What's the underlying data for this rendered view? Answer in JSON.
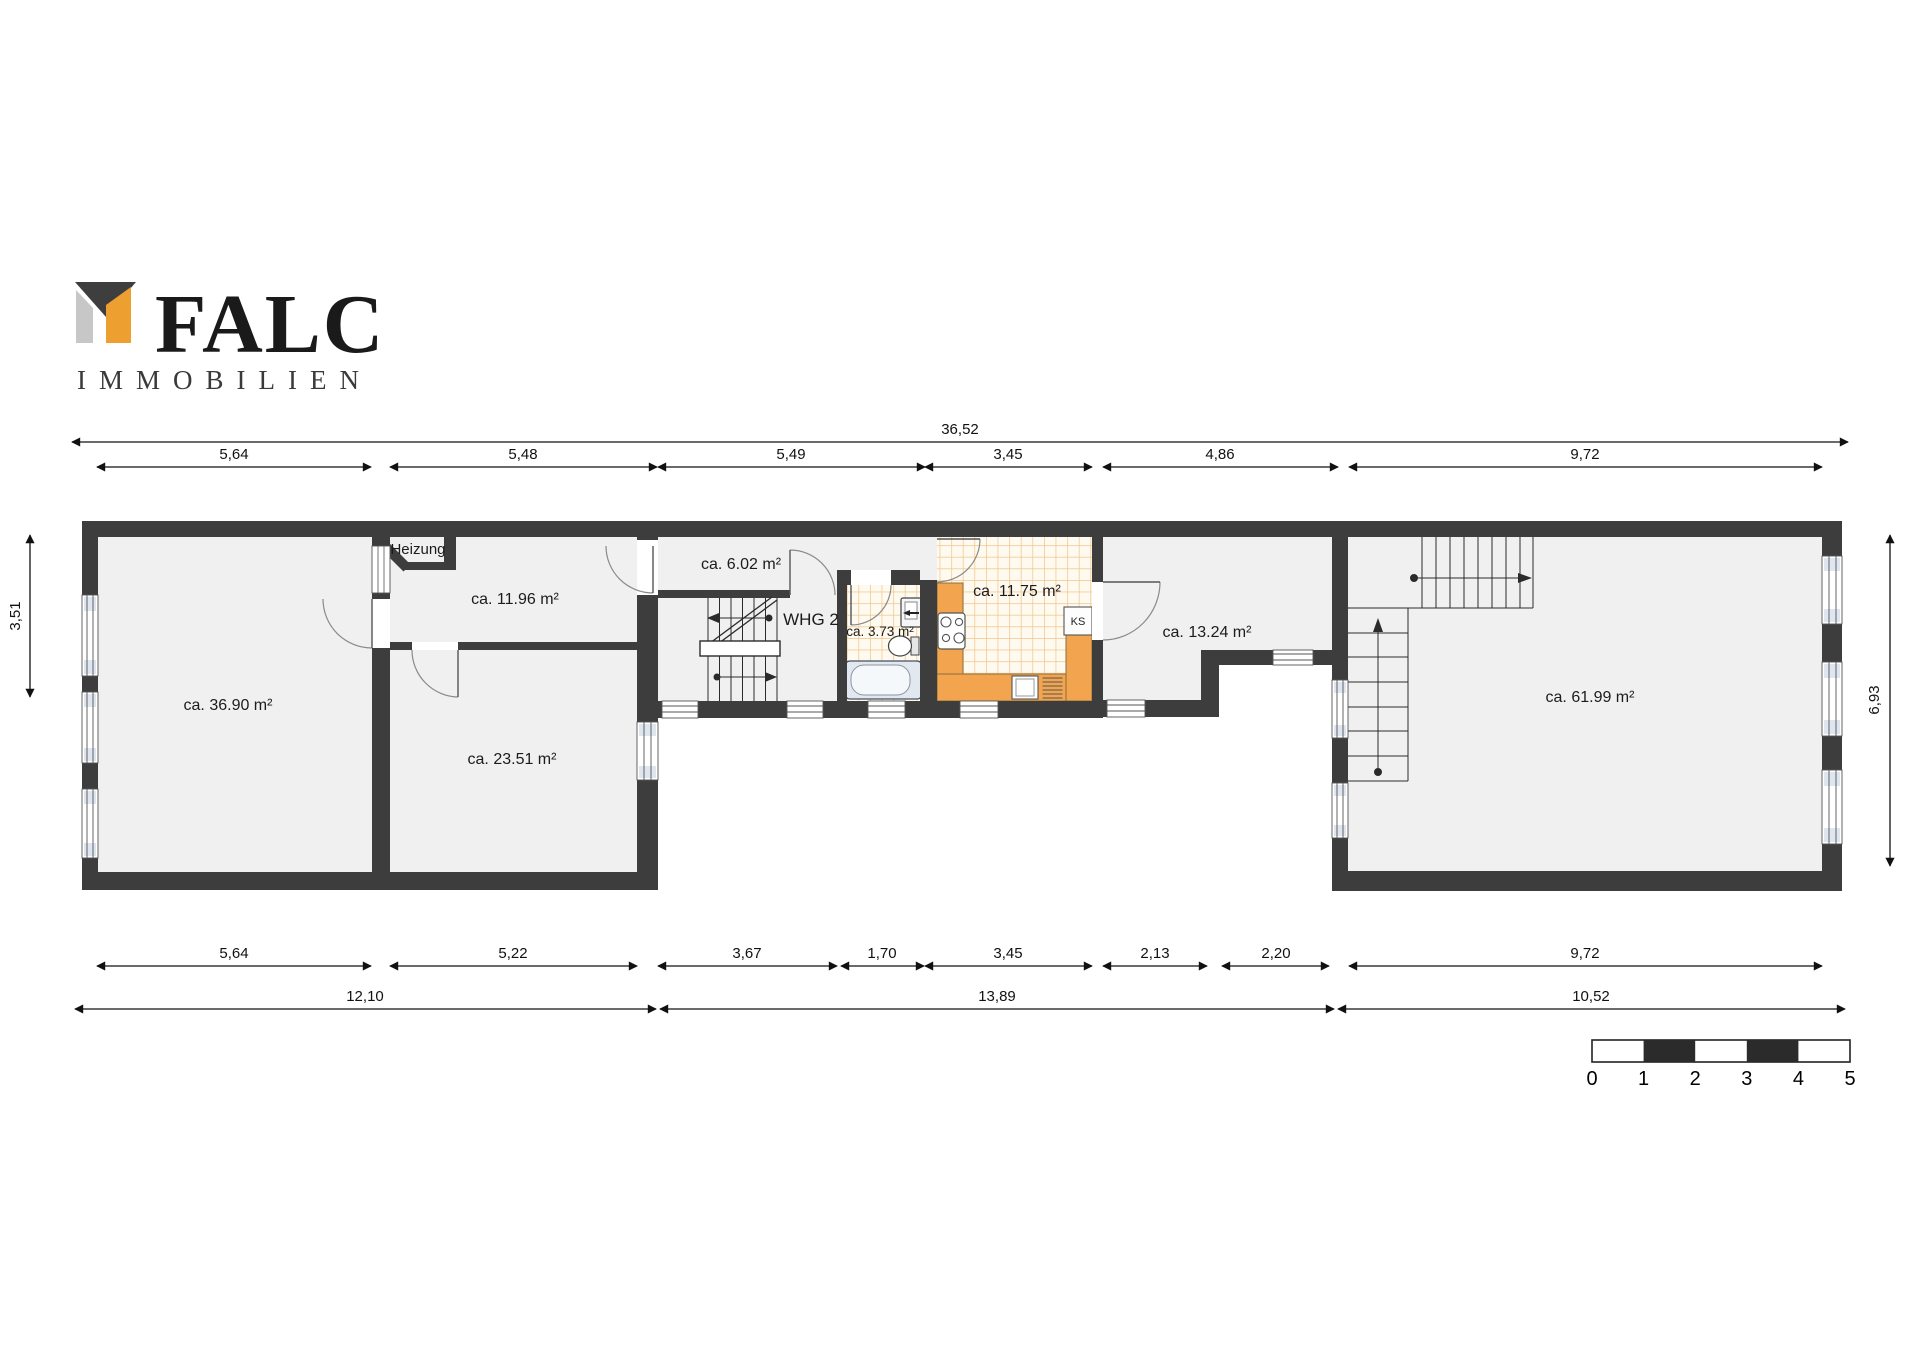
{
  "logo": {
    "brand": "FALC",
    "subtitle": "IMMOBILIEN",
    "brand_color": "#EDA02F",
    "mark_dark": "#3F3E3E",
    "mark_gray": "#C8C7C7"
  },
  "rooms": {
    "living": "ca. 36.90 m²",
    "room_1196": "ca. 11.96 m²",
    "room_2351": "ca. 23.51 m²",
    "hall": "ca. 6.02 m²",
    "whg": "WHG 2",
    "bath": "ca. 3.73 m²",
    "kitchen": "ca. 11.75 m²",
    "room_1324": "ca. 13.24 m²",
    "big_room": "ca. 61.99 m²",
    "heizung": "Heizung",
    "fridge": "KS"
  },
  "dimensions": {
    "top_total": "36,52",
    "top": [
      "5,64",
      "5,48",
      "5,49",
      "3,45",
      "4,86",
      "9,72"
    ],
    "bottom": [
      "5,64",
      "5,22",
      "3,67",
      "1,70",
      "3,45",
      "2,13",
      "2,20",
      "9,72"
    ],
    "bottom_totals": [
      "12,10",
      "13,89",
      "10,52"
    ],
    "left": "3,51",
    "right": "6,93"
  },
  "scale_bar": {
    "labels": [
      "0",
      "1",
      "2",
      "3",
      "4",
      "5"
    ]
  },
  "colors": {
    "wall": "#3d3d3d",
    "floor": "#f0f0f1",
    "tile_bg": "#fefaf0",
    "tile_line": "#f0c488",
    "counter": "#F2A54E"
  }
}
